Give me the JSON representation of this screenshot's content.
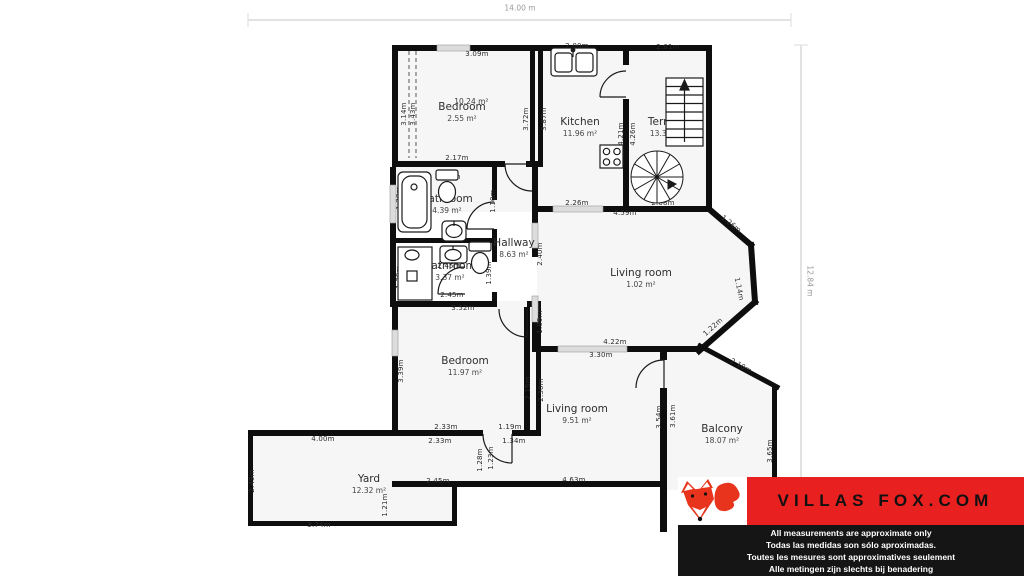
{
  "scale": {
    "width_label": "14.00 m",
    "height_label": "12.84 m"
  },
  "rooms": [
    {
      "name": "Bedroom",
      "area": "2.55 m²",
      "area_secondary": "10.24 m²"
    },
    {
      "name": "Kitchen",
      "area": "11.96 m²"
    },
    {
      "name": "Terrace",
      "area": "13.30 m²"
    },
    {
      "name": "Bathroom",
      "area": "4.39 m²"
    },
    {
      "name": "Hallway",
      "area": "8.63 m²"
    },
    {
      "name": "Bathroom",
      "area": "3.37 m²"
    },
    {
      "name": "Living room",
      "area": "1.02 m²"
    },
    {
      "name": "Bedroom",
      "area": "11.97 m²"
    },
    {
      "name": "Living room",
      "area": "9.51 m²"
    },
    {
      "name": "Balcony",
      "area": "18.07 m²"
    },
    {
      "name": "Yard",
      "area": "12.32 m²"
    }
  ],
  "dims": [
    "3.09m",
    "2.00m",
    "2.01m",
    "3.14m",
    "3.43m",
    "3.72m",
    "3.87m",
    "4.21m",
    "4.26m",
    "2.17m",
    "2.45m",
    "1.28m",
    "1.10m",
    "2.45m",
    "2.45m",
    "1.39m",
    "1.39m",
    "2.45m",
    "3.52m",
    "2.26m",
    "4.59m",
    "2.08m",
    "1.26m",
    "1.14m",
    "1.22m",
    "2.40m",
    "1.09m",
    "3.39m",
    "2.15m",
    "2.30m",
    "2.33m",
    "1.19m",
    "2.33m",
    "1.34m",
    "4.22m",
    "3.30m",
    "3.54m",
    "3.61m",
    "2.10m",
    "3.65m",
    "1.28m",
    "1.23m",
    "4.00m",
    "2.49m",
    "2.45m",
    "1.21m",
    "3.74m",
    "4.63m"
  ],
  "logo": {
    "brand": "VILLAS FOX.COM",
    "disclaimers": [
      "All measurements are approximate only",
      "Todas las medidas son sólo aproximadas.",
      "Toutes les mesures sont approximatives seulement",
      "Alle metingen zijn slechts bij benadering"
    ]
  },
  "colors": {
    "wall": "#0e0e0e",
    "window": "#dcdcdc",
    "room_fill": "#f6f6f6",
    "logo_red": "#e92020",
    "logo_bar": "#151515",
    "fox": "#e8341c"
  }
}
